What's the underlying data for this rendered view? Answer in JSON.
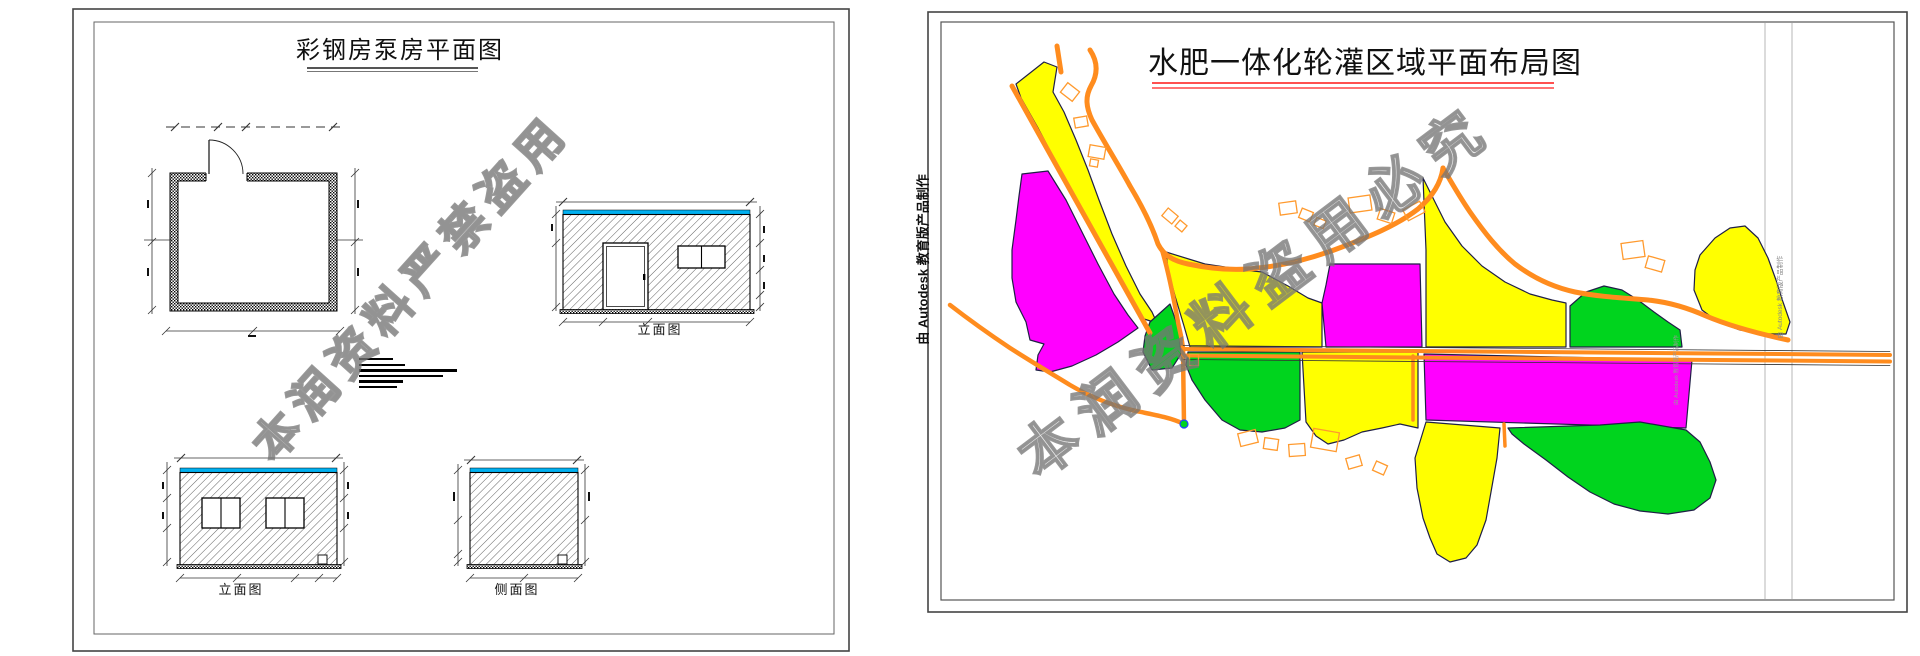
{
  "left_panel": {
    "title": "彩钢房泵房平面图",
    "view_labels": {
      "elevation_main": "立面图",
      "elevation_rear": "立面图",
      "side_view": "侧面图"
    },
    "watermark": "本润资料严禁盗用"
  },
  "right_panel": {
    "title": "水肥一体化轮灌区域平面布局图",
    "watermark": "本润资料盗用必究",
    "autodesk_stamp": "由 Autodesk 教育版产品制作"
  },
  "colors": {
    "yellow": "#FFFF00",
    "magenta": "#FF00FF",
    "green": "#00D41E",
    "road": "#FF8C1E",
    "building": "#FF9A2E",
    "cyan": "#00B0F0",
    "underline": "#FF5050",
    "outline": "#1f1f46"
  }
}
